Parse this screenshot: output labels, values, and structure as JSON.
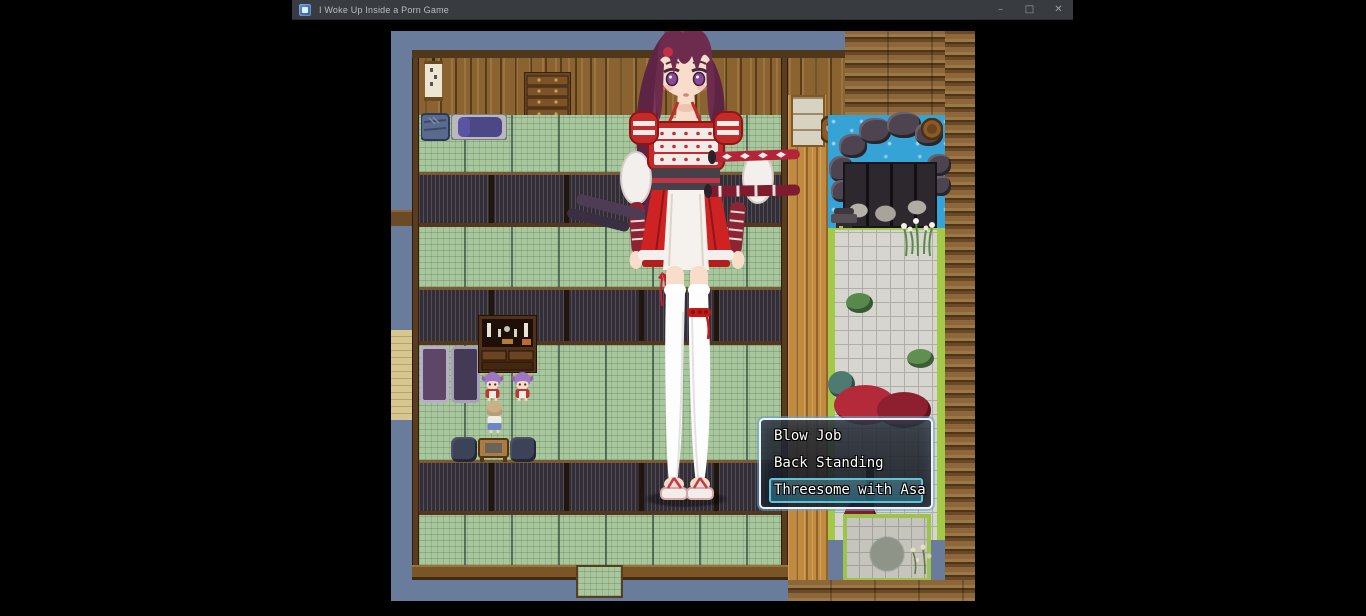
{
  "window": {
    "title": "I Woke Up Inside a Porn Game",
    "controls": {
      "minimize": "–",
      "maximize": "□",
      "close": "✕"
    }
  },
  "game": {
    "menu": {
      "items": [
        {
          "label": "Blow Job"
        },
        {
          "label": "Back Standing"
        },
        {
          "label": "Threesome with Asa"
        }
      ],
      "selected_index": 2
    },
    "colors": {
      "selection_accent": "#5fc4da",
      "menu_border": "#eef2f4",
      "tatami_green": "#a9c79d",
      "wood_wall": "#8a6330",
      "veranda_wood": "#c08a40",
      "water_blue": "#35a3d6",
      "grass_edge": "#a4c848",
      "armor_red": "#c32a2a",
      "hair_plum": "#6d2b4d",
      "sky_gray_blue": "#6a7c9b",
      "titlebar_gray": "#383b3f"
    }
  }
}
